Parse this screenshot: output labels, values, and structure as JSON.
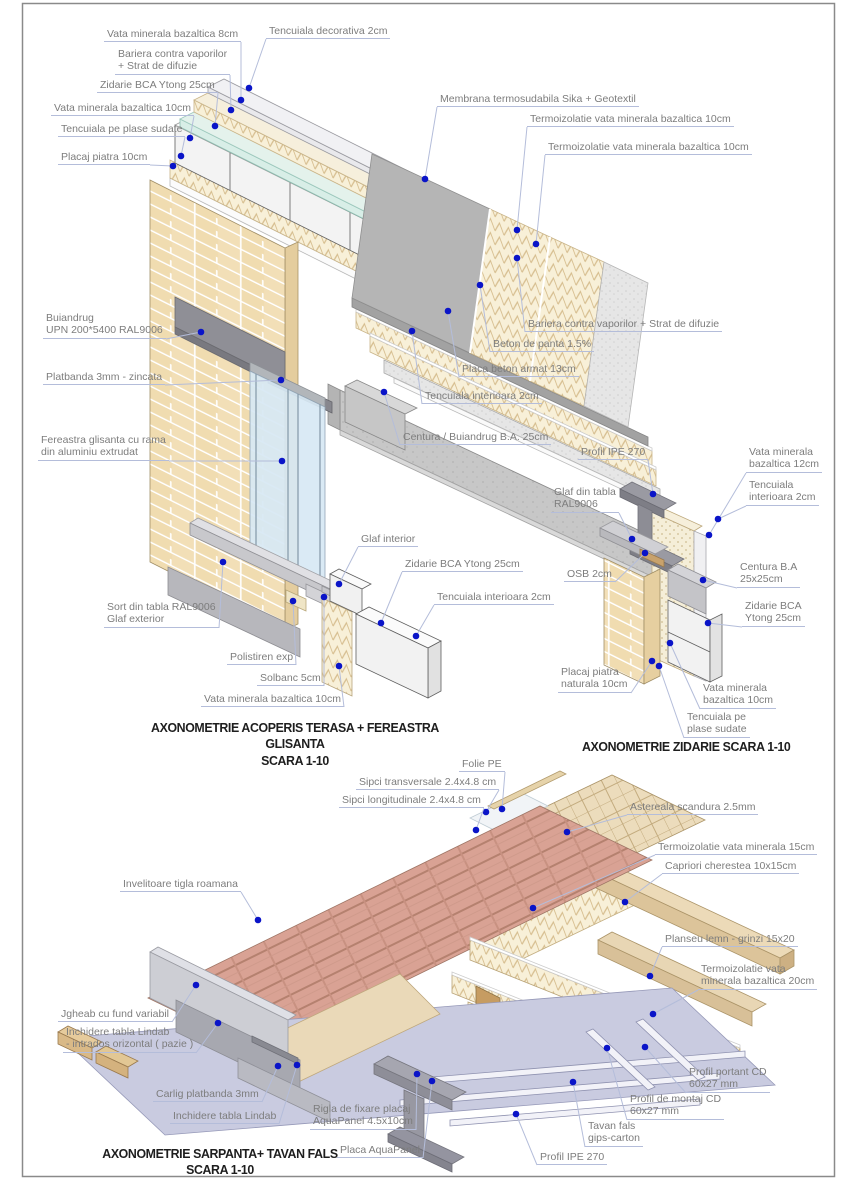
{
  "page": {
    "background": "#ffffff",
    "frame_color": "#8a8a8a"
  },
  "colors": {
    "dot": "#0a14c8",
    "leader": "#b4bdda",
    "label_text": "#7d7d7d",
    "title_text": "#1e1e1e"
  },
  "details": [
    {
      "name": "acoperis-terasa-fereastra-glisanta",
      "title": "AXONOMETRIE ACOPERIS TERASA + FEREASTRA GLISANTA",
      "scale": "SCARA 1-10",
      "labels": [
        {
          "text": "Tencuiala decorativa 2cm"
        },
        {
          "text": "Vata minerala bazaltica 8cm"
        },
        {
          "text": "Bariera contra vaporilor\n+ Strat de difuzie"
        },
        {
          "text": "Zidarie BCA Ytong 25cm"
        },
        {
          "text": "Vata minerala bazaltica 10cm"
        },
        {
          "text": "Tencuiala pe plase sudate"
        },
        {
          "text": "Placaj piatra 10cm"
        },
        {
          "text": "Membrana termosudabila Sika + Geotextil"
        },
        {
          "text": "Termoizolatie vata minerala bazaltica 10cm"
        },
        {
          "text": "Termoizolatie vata minerala bazaltica 10cm"
        },
        {
          "text": "Bariera contra vaporilor + Strat de difuzie"
        },
        {
          "text": "Beton de panta 1.5%"
        },
        {
          "text": "Placa beton armat 13cm"
        },
        {
          "text": "Tencuiala interioara 2cm"
        },
        {
          "text": "Centura / Buiandrug B.A. 25cm"
        },
        {
          "text": "Buiandrug\nUPN 200*5400 RAL9006"
        },
        {
          "text": "Platbanda 3mm - zincata"
        },
        {
          "text": "Fereastra glisanta cu rama\ndin aluminiu extrudat"
        },
        {
          "text": "Glaf interior"
        },
        {
          "text": "Zidarie BCA Ytong 25cm"
        },
        {
          "text": "Tencuiala interioara 2cm"
        },
        {
          "text": "Sort din tabla RAL9006\nGlaf exterior"
        },
        {
          "text": "Polistiren exp"
        },
        {
          "text": "Solbanc 5cm"
        },
        {
          "text": "Vata minerala bazaltica 10cm"
        }
      ]
    },
    {
      "name": "zidarie",
      "title": "AXONOMETRIE ZIDARIE  SCARA 1-10",
      "scale": "",
      "labels": [
        {
          "text": "Profil IPE 270"
        },
        {
          "text": "Vata minerala\nbazaltica 12cm"
        },
        {
          "text": "Glaf din tabla\nRAL9006"
        },
        {
          "text": "Tencuiala\ninterioara 2cm"
        },
        {
          "text": "OSB 2cm"
        },
        {
          "text": "Centura B.A\n25x25cm"
        },
        {
          "text": "Zidarie BCA\nYtong 25cm"
        },
        {
          "text": "Placaj piatra\nnaturala 10cm"
        },
        {
          "text": "Vata minerala\nbazaltica 10cm"
        },
        {
          "text": "Tencuiala pe\nplase sudate"
        }
      ]
    },
    {
      "name": "sarpanta-tavan-fals",
      "title": "AXONOMETRIE SARPANTA+ TAVAN FALS",
      "scale": "SCARA 1-10",
      "labels": [
        {
          "text": "Folie PE"
        },
        {
          "text": "Sipci transversale 2.4x4.8 cm"
        },
        {
          "text": "Sipci longitudinale 2.4x4.8 cm"
        },
        {
          "text": "Astereala scandura 2.5mm"
        },
        {
          "text": "Termoizolatie vata minerala 15cm"
        },
        {
          "text": "Capriori cherestea 10x15cm"
        },
        {
          "text": "Invelitoare tigla roamana"
        },
        {
          "text": "Planseu lemn - grinzi 15x20"
        },
        {
          "text": "Termoizolatie vata\nminerala bazaltica 20cm"
        },
        {
          "text": "Jgheab cu fund variabil"
        },
        {
          "text": "Inchidere tabla Lindab\n- intrados orizontal ( pazie )"
        },
        {
          "text": "Profil portant CD\n60x27 mm"
        },
        {
          "text": "Carlig platbanda 3mm"
        },
        {
          "text": "Profil de montaj CD\n60x27 mm"
        },
        {
          "text": "Tavan fals\ngips-carton"
        },
        {
          "text": "Rigla de fixare placaj\nAquaPanel 4.5x10cm"
        },
        {
          "text": "Inchidere tabla Lindab"
        },
        {
          "text": "Placa AquaPanel"
        },
        {
          "text": "Profil IPE 270"
        }
      ]
    }
  ]
}
